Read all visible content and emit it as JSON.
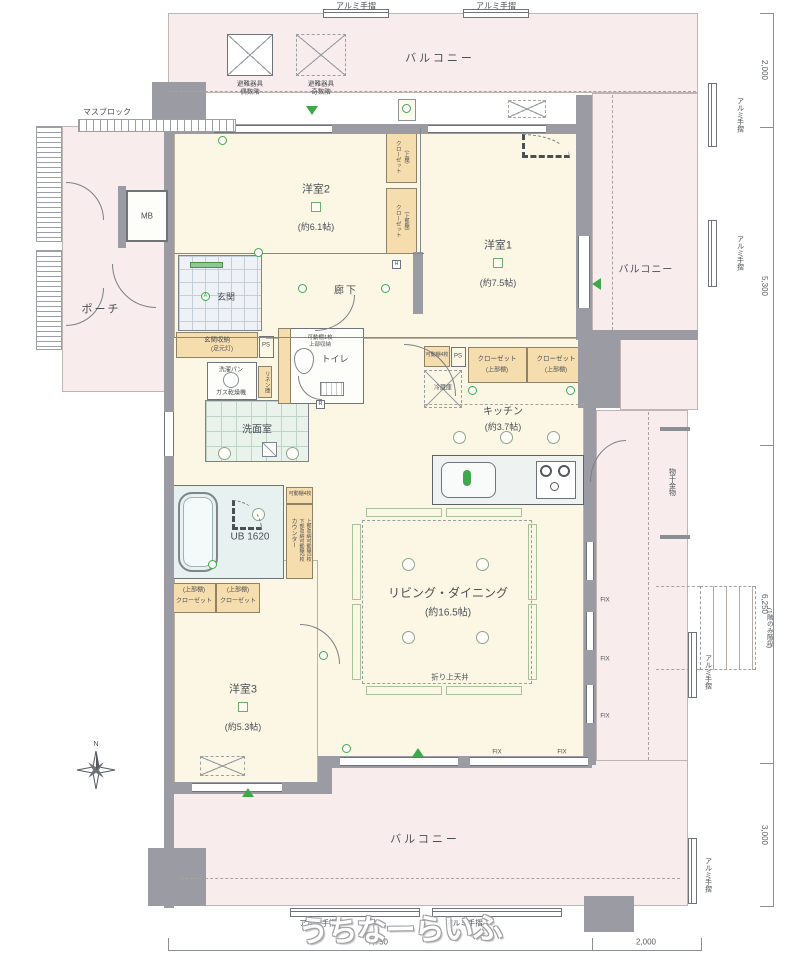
{
  "labels": {
    "handrail": "アルミ手摺",
    "balcony": "バルコニー",
    "evac_equipment": "避難器具",
    "evac_even": "偶数階",
    "evac_odd": "奇数階",
    "mas_block": "マスブロック",
    "mb": "MB",
    "porch": "ポーチ",
    "room2": "洋室2",
    "room2_size": "(約6.1帖)",
    "room1": "洋室1",
    "room1_size": "(約7.5帖)",
    "room3": "洋室3",
    "room3_size": "(約5.3帖)",
    "genkan": "玄関",
    "hallway": "廊下",
    "genkan_storage": "玄関収納",
    "foot_light": "(足元灯)",
    "ps": "PS",
    "toilet": "トイレ",
    "movable_shelf_1": "可動棚1枚",
    "upper_storage": "上部収納",
    "linen": "リネン庫",
    "laundry_pan": "洗濯パン",
    "gas_dryer": "ガス乾燥機",
    "washroom": "洗面室",
    "unit_bath": "UB 1620",
    "movable_shelf_4": "可動棚4枚",
    "closet": "クローゼット",
    "upper_shelf": "(上部棚)",
    "upper_shelf_short": "(上棚)",
    "fridge": "冷蔵庫",
    "kitchen": "キッチン",
    "kitchen_size": "(約3.7帖)",
    "counter": "カウンター",
    "counter_lower": "下部収納可動棚2枚",
    "counter_upper": "上部収納可動棚1枚",
    "living": "リビング・ダイニング",
    "living_size": "(約16.5帖)",
    "coffered_ceiling": "折り上天井",
    "fix": "FIX",
    "laundry_hook": "物干金物",
    "stairs_note": "(1階のみ階段)",
    "marker_r": "R",
    "marker_h": "H",
    "marker_a": "A",
    "compass_n": "N"
  },
  "dimensions": {
    "right_top": "2,000",
    "right_upper": "5,300",
    "right_lower": "6,250",
    "right_bottom": "3,000",
    "bottom_left": "7,750",
    "bottom_right": "2,000"
  },
  "watermark": "うちなーらいふ",
  "colors": {
    "wall": "#9b9ca3",
    "balcony": "#f8ecec",
    "room": "#fcf7e5",
    "closet": "#f6ddae",
    "accent_green": "#3fa84c"
  }
}
